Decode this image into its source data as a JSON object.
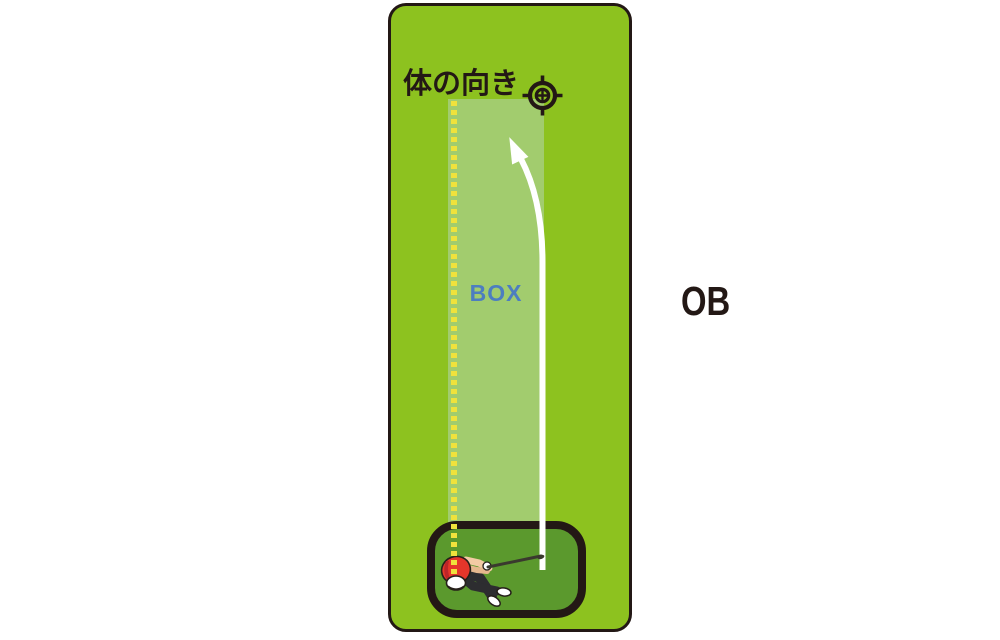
{
  "scene": {
    "heading": "体の向き",
    "box_label": "BOX",
    "ob_label": "OB"
  },
  "icons": {
    "target": "target-crosshair-icon",
    "arrow": "ball-flight-arrow",
    "golfer": "golfer-figure",
    "alignment_line": "alignment-dotted-line"
  },
  "colors": {
    "course_green": "#8DC21F",
    "box_green": "#A2CC6E",
    "tee_green": "#5B992D",
    "outline_black": "#231815",
    "alignment_yellow": "#F0E23C",
    "box_text_blue": "#4D7EC0",
    "arrow_white": "#FFFFFF",
    "golfer_shirt_red": "#E5362A"
  }
}
